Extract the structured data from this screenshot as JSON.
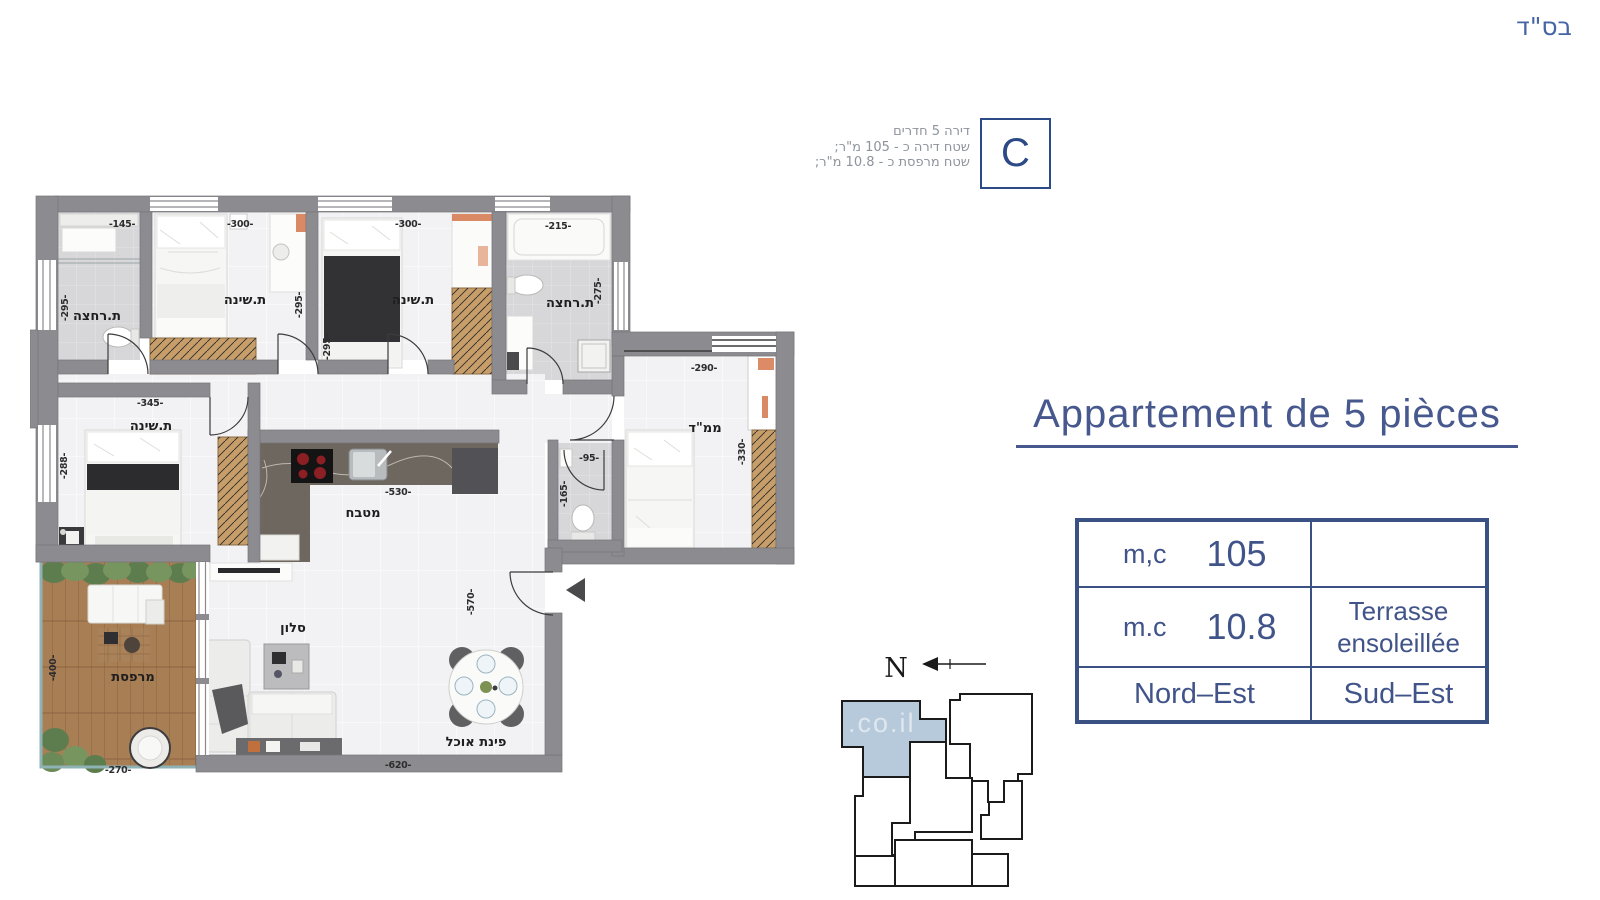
{
  "header": {
    "bsd": "בס\"ד"
  },
  "apartment_badge": {
    "letter": "C",
    "line1": "דירה 5 חדרים",
    "line2": "שטח דירה כ - 105 מ\"ר;",
    "line3": "שטח מרפסת כ - 10.8 מ\"ר;"
  },
  "title": "Appartement de 5 pièces",
  "summary_table": {
    "r1c1_label": "m,c",
    "r1c1_value": "105",
    "r1c2": "",
    "r2c1_label": "m.c",
    "r2c1_value": "10.8",
    "r2c2_line1": "Terrasse",
    "r2c2_line2": "ensoleillée",
    "r3c1": "Nord–Est",
    "r3c2": "Sud–Est"
  },
  "keyplan": {
    "north": "N",
    "watermark": ".co.il"
  },
  "colors": {
    "accent_blue": "#46588d",
    "table_border": "#3a5183",
    "keyplan_highlight": "#b7cadb",
    "wall_gray": "#8c8c90"
  },
  "plan": {
    "rooms": {
      "bath1": "ת.רחצה",
      "bed1": "ת.שינה",
      "bed2": "ת.שינה",
      "bath2": "ת.רחצה",
      "mamad": "ממ\"ד",
      "bed3": "ת.שינה",
      "kitchen": "מטבח",
      "living": "סלון",
      "dining": "פינת אוכל",
      "balcony": "מרפסת"
    },
    "dims": {
      "bath1_w": "-145-",
      "bed1_w": "-300-",
      "bed2_w": "-300-",
      "bath2_w": "-215-",
      "bath1_h": "-295-",
      "bed1_h": "-295-",
      "bed2_h": "-295-",
      "bath2_h": "-275-",
      "mamad_w": "-290-",
      "mamad_h": "-330-",
      "bed3_w": "-345-",
      "bed3_h": "-288-",
      "kitchen_w": "-530-",
      "wc_w": "-95-",
      "wc_h": "-165-",
      "living_h": "-570-",
      "living_w": "-620-",
      "balcony_h": "-400-",
      "balcony_w": "-270-"
    }
  }
}
